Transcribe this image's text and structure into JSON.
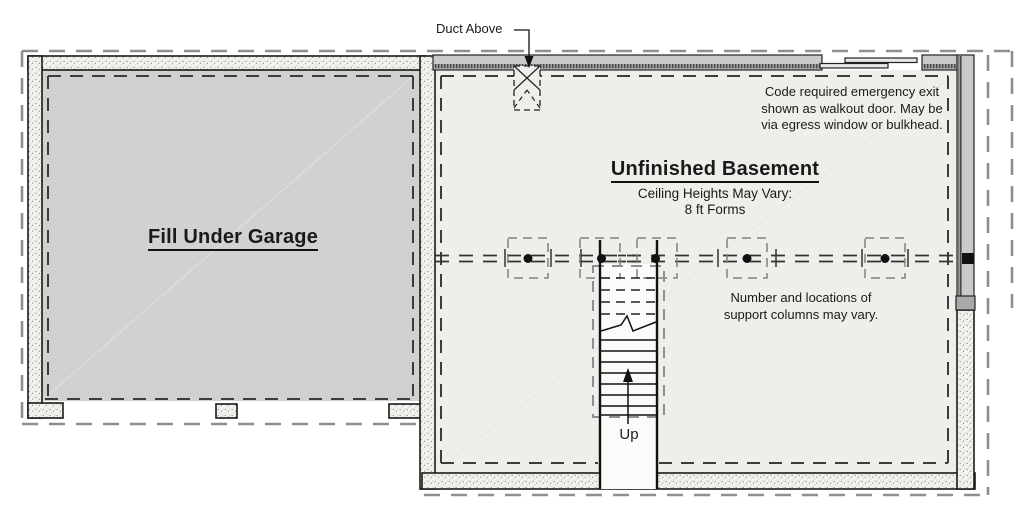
{
  "plan": {
    "duct_label": "Duct Above",
    "emergency_note": {
      "line1": "Code required emergency exit",
      "line2": "shown as walkout door. May be",
      "line3": "via egress window or bulkhead."
    },
    "basement": {
      "title": "Unfinished Basement",
      "subtitle1": "Ceiling Heights May Vary:",
      "subtitle2": "8 ft Forms"
    },
    "garage_label": "Fill Under Garage",
    "columns_note": {
      "line1": "Number and locations of",
      "line2": "support columns may vary."
    },
    "up_label": "Up"
  },
  "colors": {
    "garage_fill": "#d1d1d0",
    "basement_fill": "#efeeea",
    "wall_outline": "#1a1a1a",
    "frame_wall_fill": "#cacaca",
    "sill_stripe": "#8f8f8f",
    "inner_dash": "#3c3c3c",
    "outer_dash": "#8f8f8f",
    "column_dash": "#808080",
    "text": "#1a1a1a"
  }
}
